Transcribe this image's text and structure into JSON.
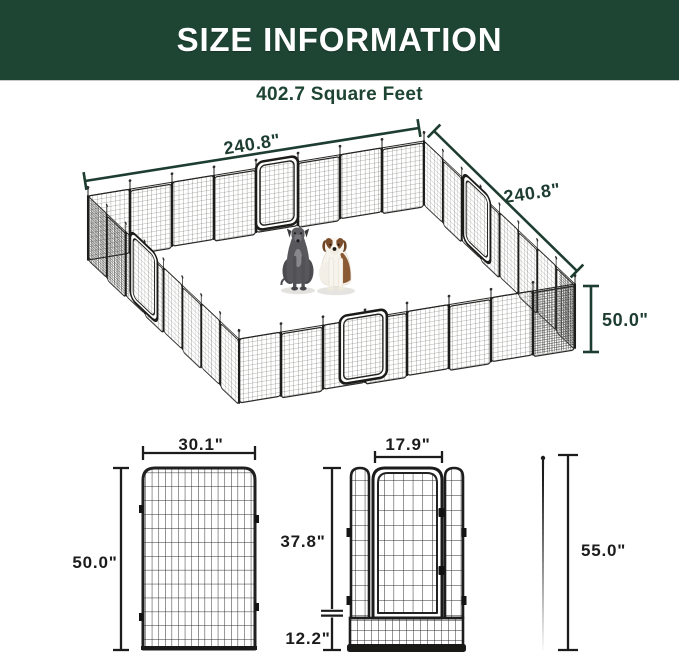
{
  "header": {
    "title": "SIZE INFORMATION"
  },
  "subtitle": "402.7 Square Feet",
  "colors": {
    "header_bg": "#1e4434",
    "accent_text": "#1e3d31",
    "diagram_text": "#1c1c1c",
    "fence_metal": "#1f1f1f"
  },
  "playpen": {
    "width_label": "240.8\"",
    "depth_label": "240.8\"",
    "height_label": "50.0\"",
    "figures": [
      "great-dane-figure",
      "saint-bernard-figure"
    ]
  },
  "panel": {
    "width_label": "30.1\"",
    "height_label": "50.0\""
  },
  "gate": {
    "door_width_label": "17.9\"",
    "upper_height_label": "37.8\"",
    "lower_height_label": "12.2\""
  },
  "stake": {
    "height_label": "55.0\""
  }
}
